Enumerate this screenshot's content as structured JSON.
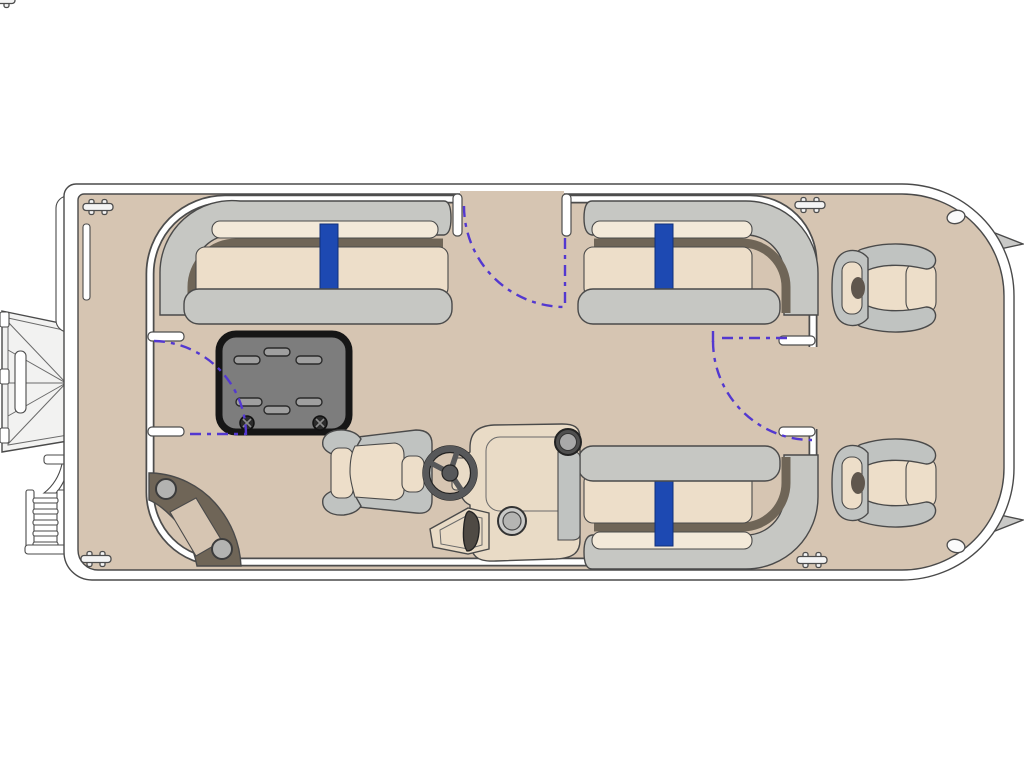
{
  "diagram": {
    "type": "pontoon-boat-floorplan",
    "view": "top-down",
    "components": [
      "hull-deck",
      "perimeter-fence",
      "bow-boarding-gangway",
      "boarding-ladder",
      "bow-side-panel",
      "gate-hinge-slot",
      "bench-seat-bow-port",
      "bench-seat-bow-starboard",
      "bench-seat-aft-starboard",
      "removable-table",
      "corner-speaker-step",
      "captain-chair",
      "steering-wheel",
      "helm-console",
      "throttle-lever",
      "rear-chair-port",
      "rear-chair-starboard",
      "gate-bow-center",
      "gate-port-side",
      "gate-starboard-side",
      "gate-swing-arc",
      "cleat",
      "stern-light",
      "stern-fin"
    ],
    "counts": {
      "bench_seats": 3,
      "rear_chairs": 2,
      "gates": 3,
      "cleats": 4,
      "stern_lights": 2,
      "stern_fins": 2,
      "table_slots": 6,
      "table_screws": 2
    }
  },
  "colors": {
    "background": "#ffffff",
    "deck": "#d6c5b2",
    "cushion": "#eddec9",
    "cushion_light": "#f3e9d9",
    "seat_gray": "#c6c7c3",
    "chair_gray": "#c0c3c1",
    "trim_dark": "#6f6557",
    "accent_blue": "#1d49b2",
    "table_top": "#7d7d7d",
    "table_border": "#161616",
    "slot_gray": "#9f9f9f",
    "speaker_dark": "#6f6557",
    "speaker_circle": "#b3b3b1",
    "swing_dash": "#5338d0",
    "outline": "#4a4a4a",
    "structure_white": "#ffffff",
    "structure_light": "#f2f2f1",
    "console_cream": "#e9dbc6",
    "wheel_dark": "#57585a",
    "fin_gray": "#c9c9c7",
    "headrest_dark": "#5f564d"
  }
}
